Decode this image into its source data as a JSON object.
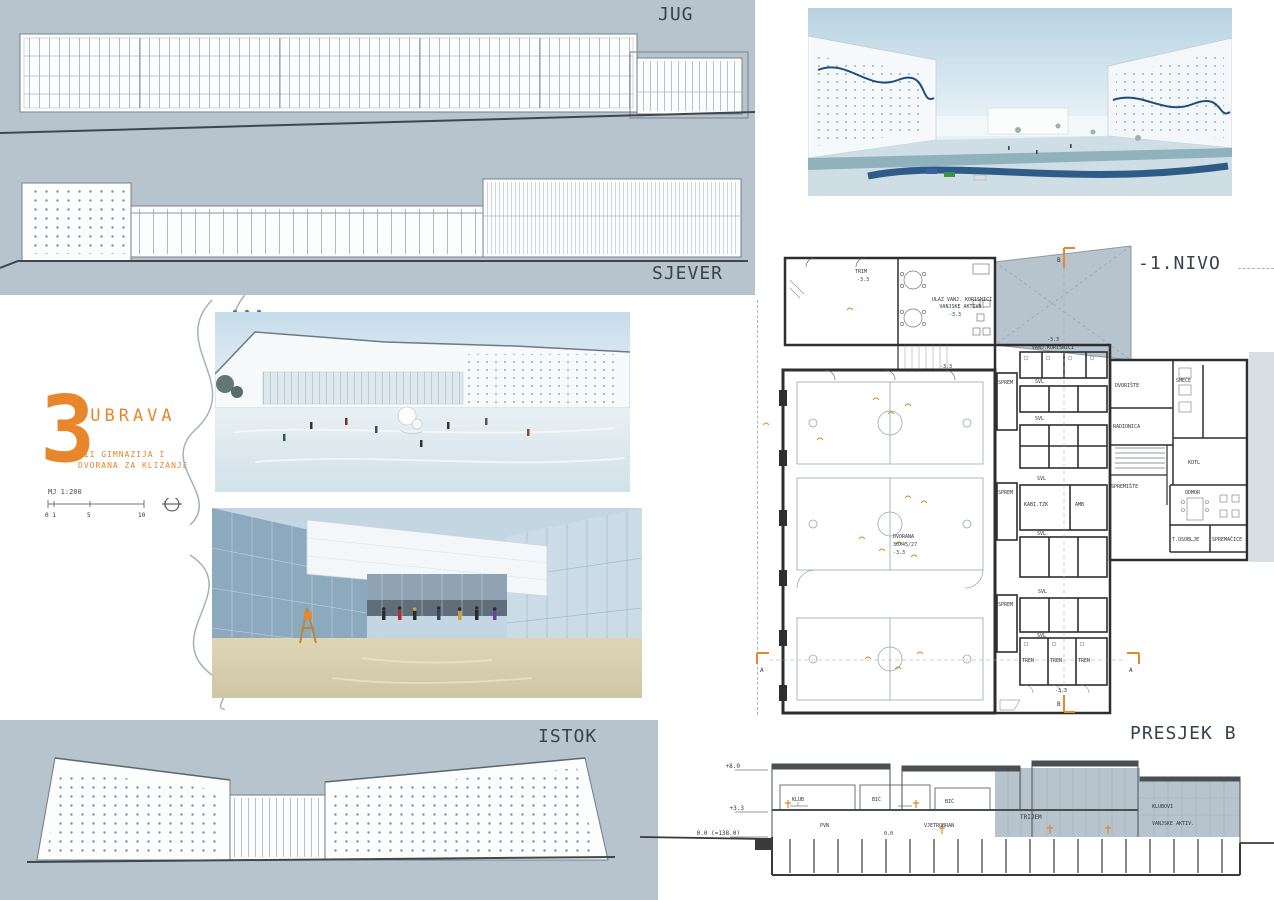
{
  "labels": {
    "jug": "JUG",
    "sjever": "SJEVER",
    "istok": "ISTOK",
    "nivo": "-1.NIVO",
    "presjek": "PRESJEK B"
  },
  "title_block": {
    "number": "3",
    "name": "DUBRAVA",
    "subtitle1": "XII GIMNAZIJA I",
    "subtitle2": "DVORANA ZA KLIZANJE",
    "scale": "MJ 1:200",
    "ticks": [
      "0 1",
      "5",
      "10"
    ]
  },
  "plan": {
    "trim": "TRIM",
    "level": "-3.3",
    "ulaz1": "ULAZ VANJ. KORISNICI",
    "ulaz2": "VANJSKE AKTIVN.",
    "vanj_korisnici": "VANJ.KORISNICI",
    "svl": "SVL",
    "sprem": "SPREM",
    "dvorana": "DVORANA",
    "dvorana_dim": "30X45/27",
    "kabi": "KABI.TZK",
    "amb": "AMB",
    "tren": "TREN",
    "dvoriste": "DVORIŠTE",
    "radionica": "RADIONICA",
    "smece": "SMEĆE",
    "kotl": "KOTL",
    "spremiste": "SPREMIŠTE",
    "odmor": "ODMOR",
    "t_osoblje": "T.OSOBLJE",
    "spremacice": "SPREMAČICE",
    "marker_a": "A",
    "marker_b": "B"
  },
  "section": {
    "levels": [
      "+8.0",
      "+3.3",
      "0.0 (=138.0)"
    ],
    "zero": "0.0",
    "klub": "KLUB",
    "bic": "BIĆ",
    "pvn": "PVN",
    "vjetrobran": "VJETROBRAN",
    "trijem": "TRIJEM",
    "klubovi": "KLUBOVI",
    "vanjske_aktiv": "VANJSKE AKTIV."
  },
  "colors": {
    "panel": "#b7c4ce",
    "accent": "#e8862c",
    "ink": "#39424a",
    "wall": "#2e2e2e",
    "teal": "#47808d",
    "rink": "#1d4e7c"
  }
}
